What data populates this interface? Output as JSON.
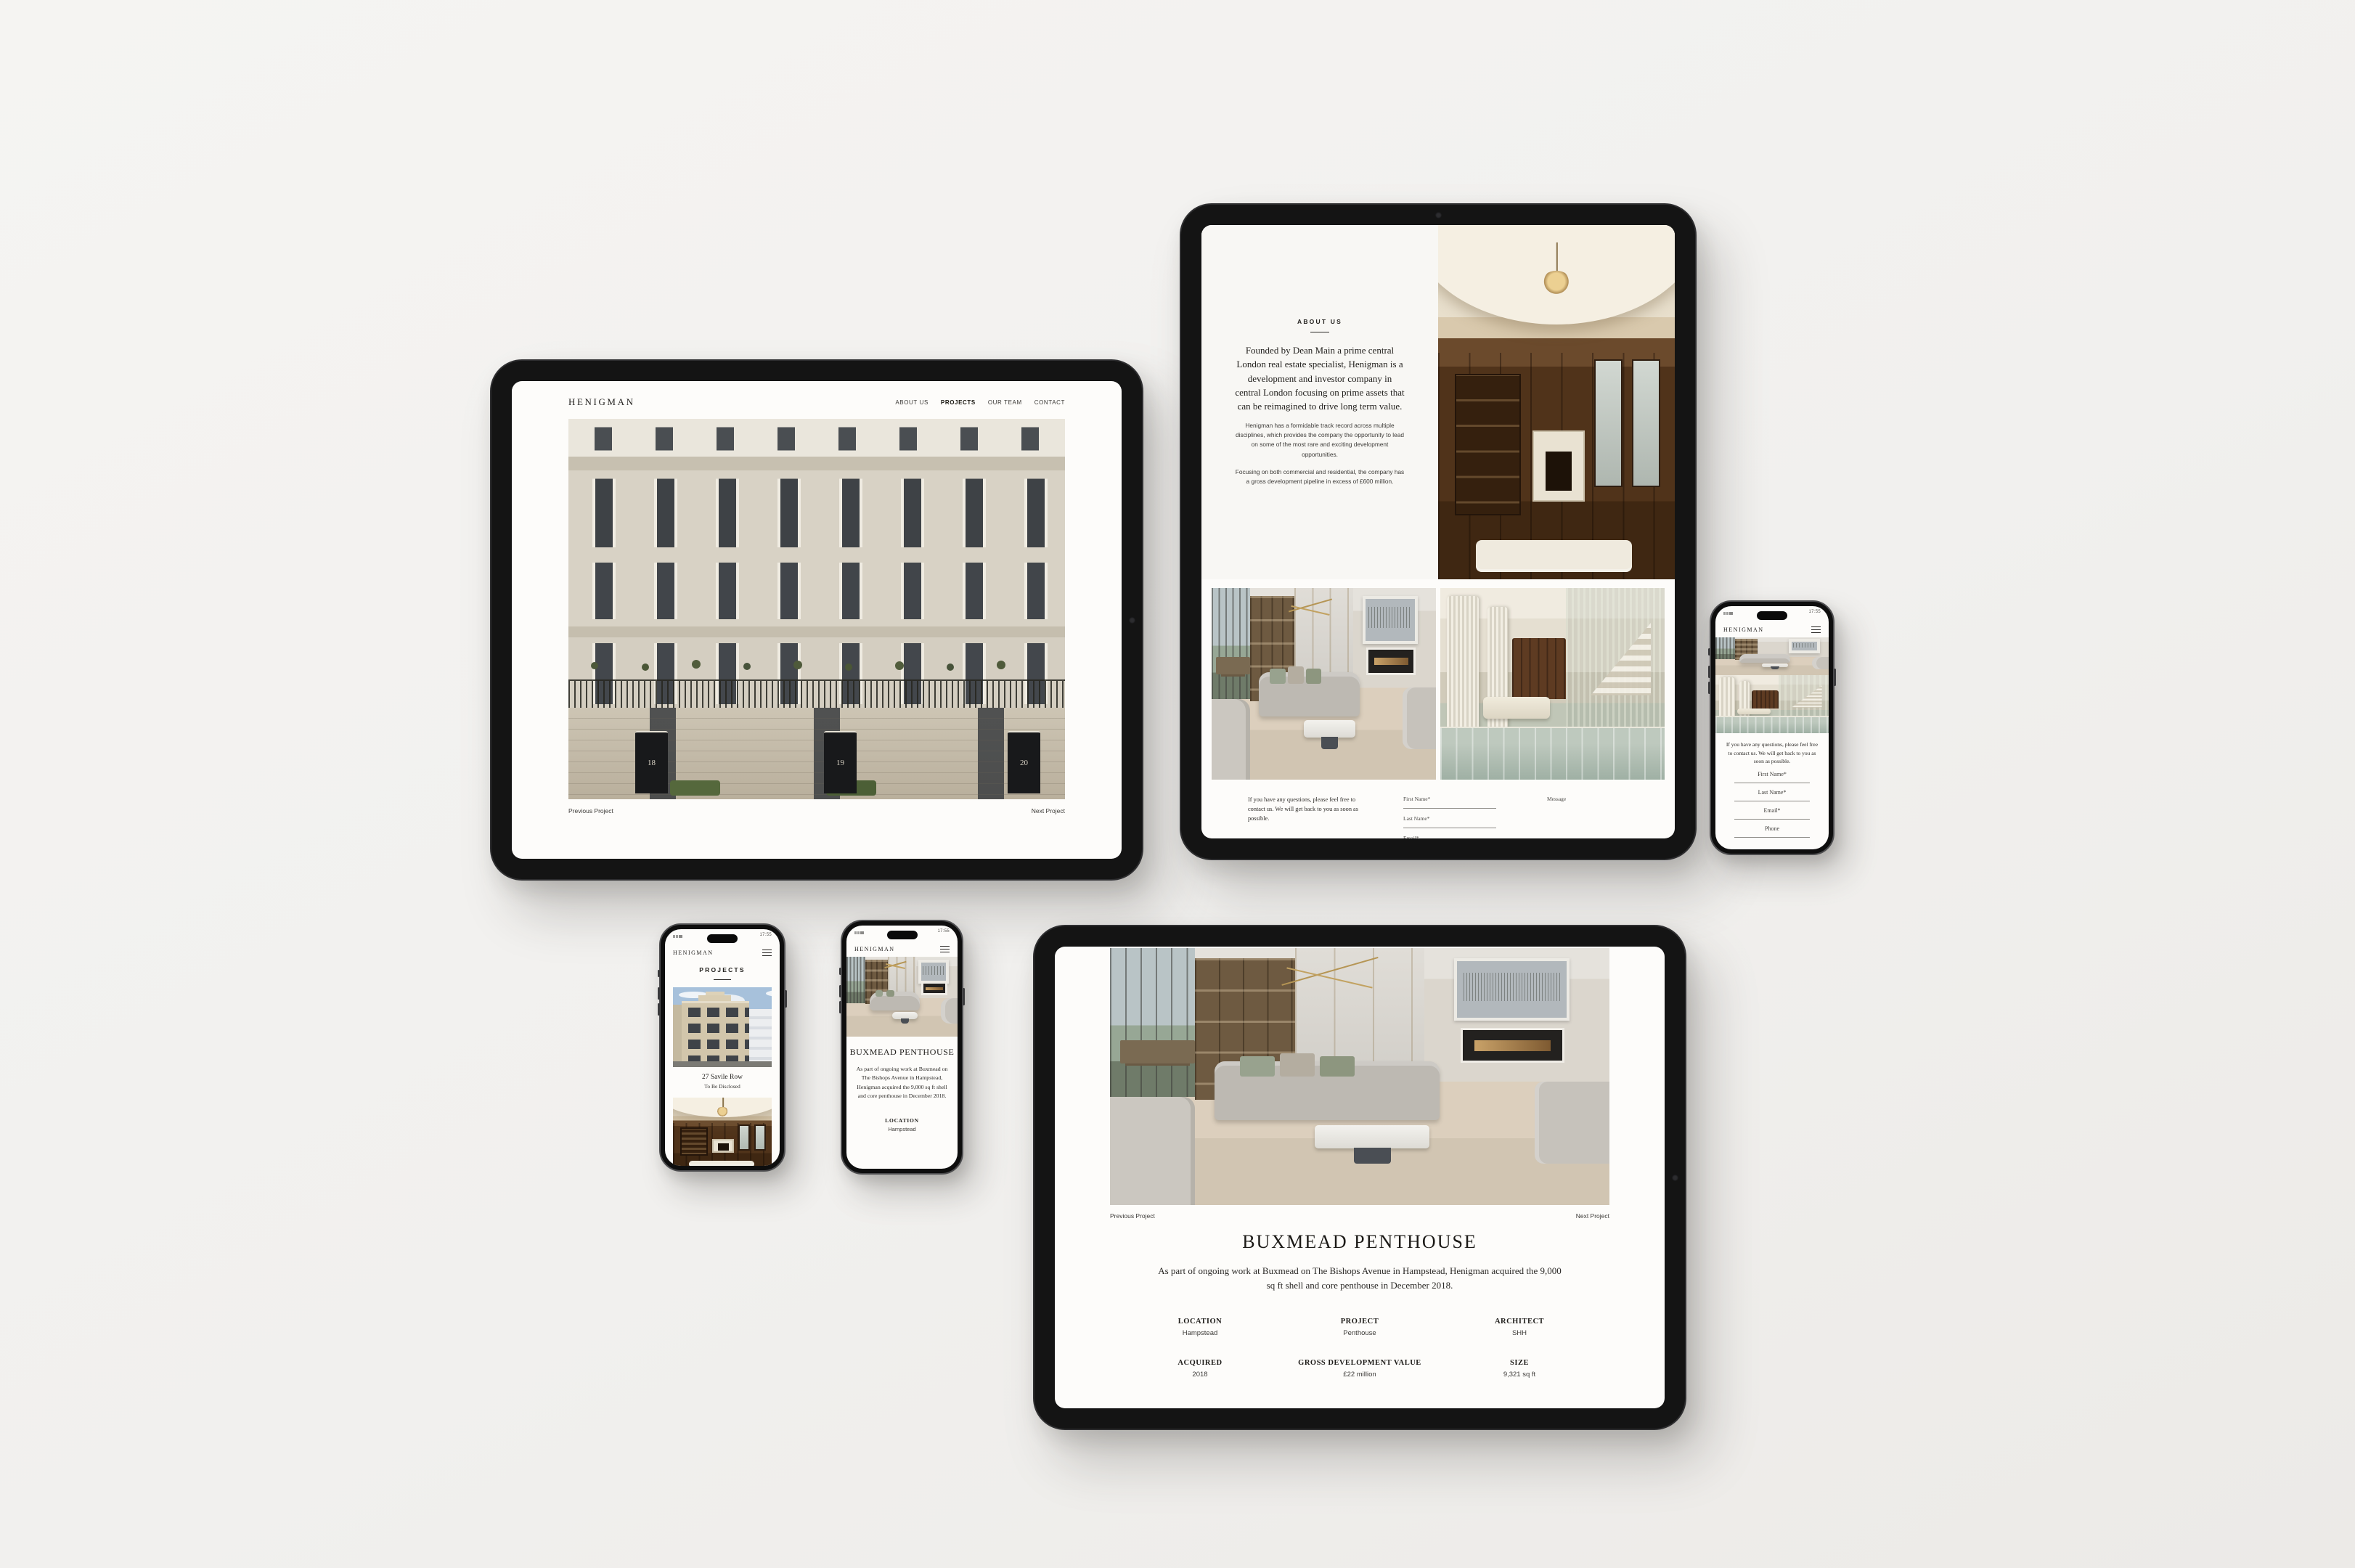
{
  "brand": {
    "wordmark": "HENIGMAN"
  },
  "status": {
    "time": "17:55"
  },
  "icons": {
    "menu": "hamburger-menu (three lines)",
    "camera": "front-camera dot"
  },
  "colors": {
    "canvas": "#f1f0ee",
    "frame": "#141414",
    "screen": "#fdfcfa",
    "ink": "#1d1b19"
  },
  "nav": {
    "about": "ABOUT US",
    "projects": "PROJECTS",
    "team": "OUR TEAM",
    "contact": "CONTACT"
  },
  "pager": {
    "previous": "Previous Project",
    "next": "Next Project"
  },
  "savile_project": {
    "doors": [
      "18",
      "19",
      "20"
    ]
  },
  "about_page": {
    "heading": "ABOUT US",
    "lead": "Founded by Dean Main a prime central London real estate specialist, Henigman is a development and investor company in central London focusing on prime assets that can be reimagined to drive long term value.",
    "body1": "Henigman has a formidable track record across multiple disciplines, which provides the company the opportunity to lead on some of the most rare and exciting development opportunities.",
    "body2": "Focusing on both commercial and residential, the company has a gross development pipeline in excess of £600 million."
  },
  "contact_form": {
    "blurb": "If you have any questions, please feel free to contact us. We will get back to you as soon as possible.",
    "first_name": "First Name*",
    "last_name": "Last Name*",
    "email": "Email*",
    "phone": "Phone",
    "message": "Message"
  },
  "projects_page": {
    "heading": "PROJECTS",
    "card_title": "27 Savile Row",
    "card_status": "To Be Disclosed"
  },
  "buxmead_page": {
    "title": "BUXMEAD PENTHOUSE",
    "description": "As part of ongoing work at Buxmead on The Bishops Avenue in Hampstead, Henigman acquired the 9,000 sq ft shell and core penthouse in December 2018.",
    "details": [
      {
        "label": "LOCATION",
        "value": "Hampstead"
      },
      {
        "label": "PROJECT",
        "value": "Penthouse"
      },
      {
        "label": "ARCHITECT",
        "value": "SHH"
      },
      {
        "label": "ACQUIRED",
        "value": "2018"
      },
      {
        "label": "GROSS DEVELOPMENT VALUE",
        "value": "£22 million"
      },
      {
        "label": "SIZE",
        "value": "9,321 sq ft"
      }
    ]
  }
}
